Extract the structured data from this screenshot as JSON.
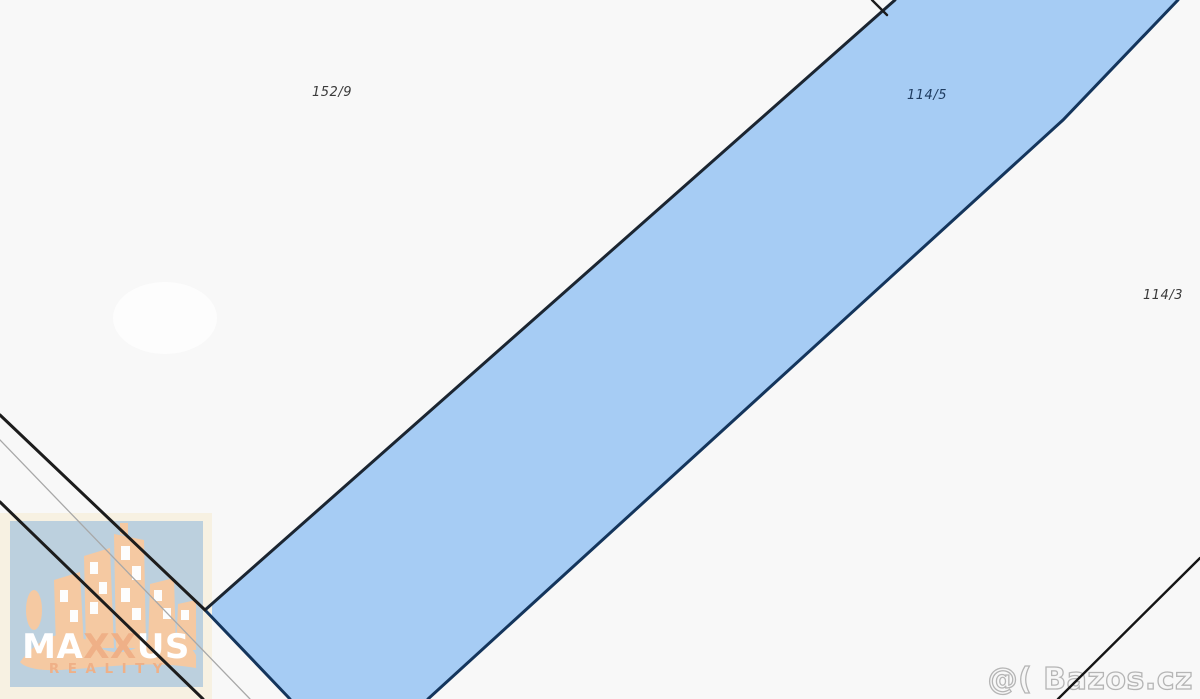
{
  "map": {
    "type": "cadastral-parcel-map",
    "background_color": "#f8f8f8",
    "boundary_line_color": "#1c1c1c",
    "parcels": {
      "left": {
        "label": "152/9",
        "fill": "#f8f8f8"
      },
      "highlighted": {
        "label": "114/5",
        "fill": "#a6ccf4",
        "outline": "#14355c"
      },
      "right": {
        "label": "114/3",
        "fill": "#f8f8f8"
      }
    },
    "label_color": "#3a3a3a",
    "highlight_label_color": "#1f3c60"
  },
  "watermarks": {
    "agency_logo": {
      "name_part_ma": "MA",
      "name_part_xx": "XX",
      "name_part_us": "US",
      "subtitle": "REALITY",
      "panel_color": "#bcd0de",
      "halo_color": "#f7f1e2",
      "art_color": "#f5c9a2",
      "accent_color": "#efb087",
      "text_color": "#ffffff"
    },
    "listing_site": {
      "text": "@( Bazos.cz",
      "outline_color": "#b5b5b5"
    }
  }
}
